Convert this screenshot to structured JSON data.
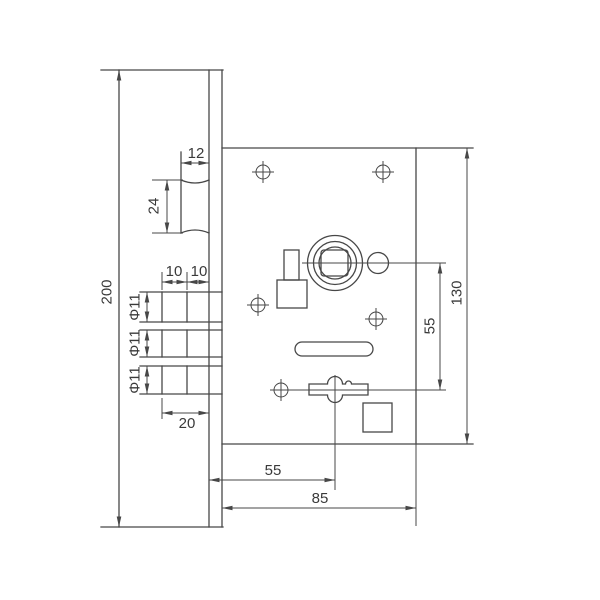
{
  "colors": {
    "line": "#474747",
    "text": "#3a3a3a",
    "background": "#ffffff"
  },
  "dims": {
    "plate_height": "200",
    "latch_width": "12",
    "latch_height": "24",
    "bolt_step_1": "10",
    "bolt_step_2": "10",
    "bolt_dia_row1": "Φ11",
    "bolt_dia_row2": "Φ11",
    "bolt_dia_row3": "Φ11",
    "bolt_throw": "20",
    "hub_to_cylinder": "55",
    "body_height": "130",
    "backset": "55",
    "body_width": "85"
  }
}
